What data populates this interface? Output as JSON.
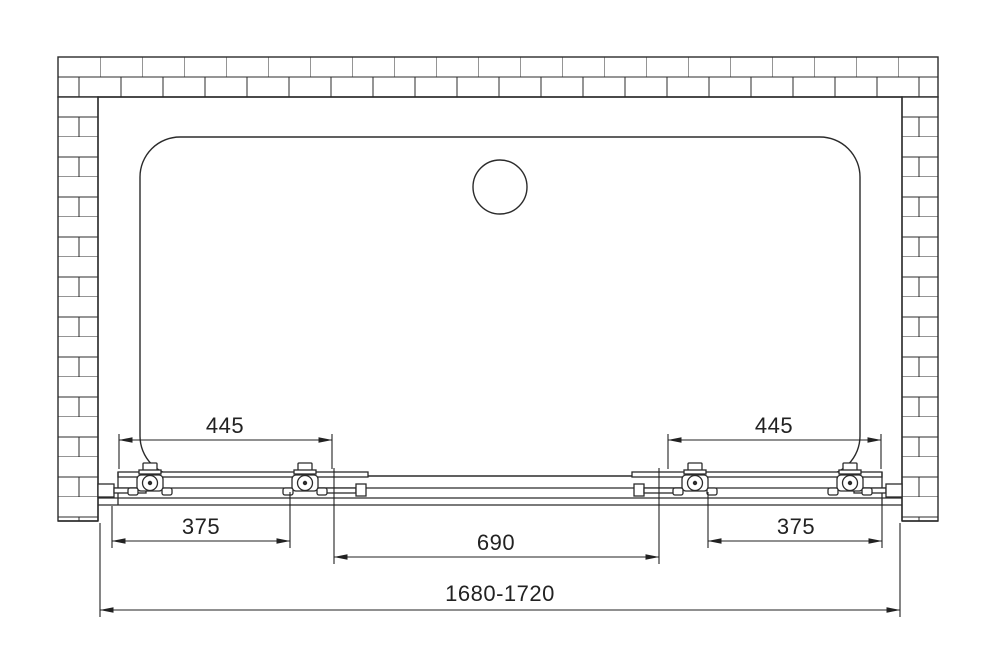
{
  "drawing": {
    "colors": {
      "line": "#2b2b2b",
      "dimension_line": "#222222",
      "background": "#ffffff"
    },
    "dimensions": {
      "upper_left": "445",
      "upper_right": "445",
      "lower_left": "375",
      "lower_center": "690",
      "lower_right": "375",
      "overall": "1680-1720"
    }
  }
}
